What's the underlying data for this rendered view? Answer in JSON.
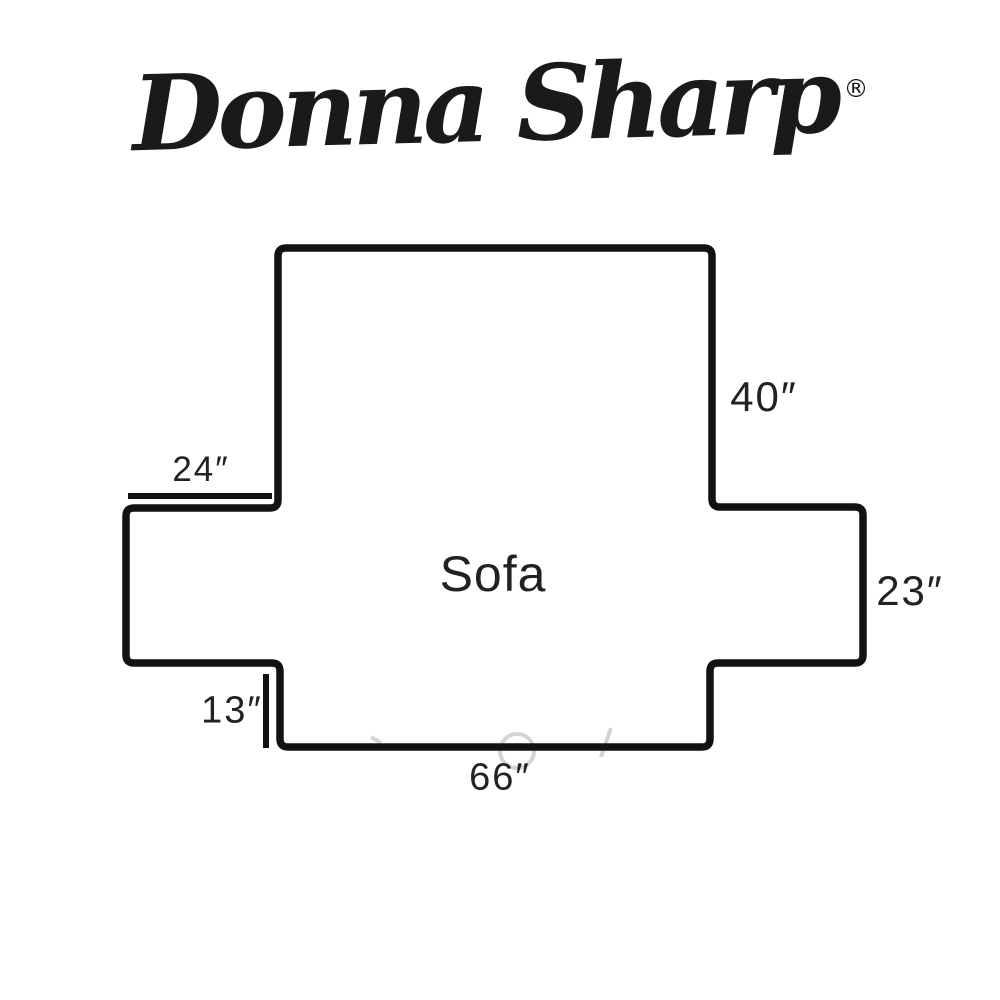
{
  "brand": {
    "name": "Donna Sharp",
    "registered_mark": "®"
  },
  "diagram": {
    "product_label": "Sofa",
    "dimensions": {
      "seat_top_left": "24″",
      "back_height": "40″",
      "side_height": "23″",
      "skirt_drop": "13″",
      "base_width": "66″"
    }
  },
  "colors": {
    "outline": "#121212",
    "label_text": "#222222",
    "background": "#ffffff",
    "watermark_remnant": "#c9c9c9"
  }
}
